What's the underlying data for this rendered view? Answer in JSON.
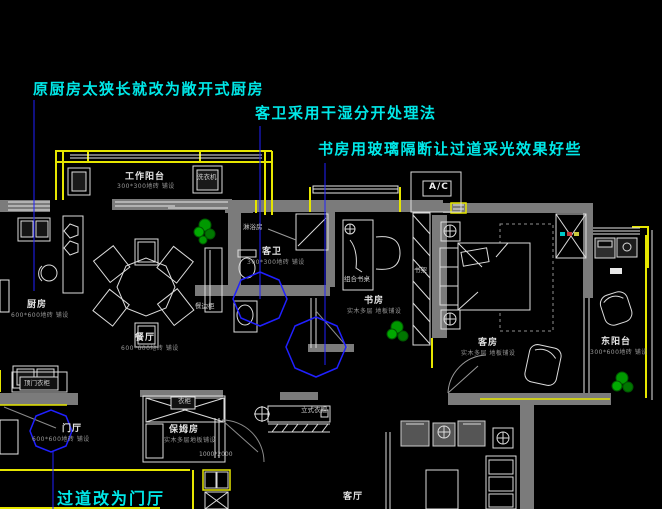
{
  "annotations": [
    {
      "name": "annotation-kitchen",
      "cls": "ann",
      "x": 33,
      "y": 81,
      "text": "原厨房太狭长就改为敞开式厨房"
    },
    {
      "name": "annotation-guest-bath",
      "cls": "ann",
      "x": 255,
      "y": 105,
      "text": "客卫采用干湿分开处理法"
    },
    {
      "name": "annotation-study",
      "cls": "ann",
      "x": 318,
      "y": 141,
      "text": "书房用玻璃隔断让过道采光效果好些"
    },
    {
      "name": "annotation-hallway",
      "cls": "ann ann-big",
      "x": 57,
      "y": 490,
      "text": "过道改为门厅"
    }
  ],
  "labels": [
    {
      "name": "room-label-work-balcony",
      "cls": "room",
      "x": 125,
      "y": 173,
      "text": "工作阳台"
    },
    {
      "name": "tile-note-work-balcony",
      "cls": "note",
      "x": 117,
      "y": 184,
      "text": "300*300地砖 铺设"
    },
    {
      "name": "furniture-label-washing-machine",
      "cls": "tiny",
      "x": 197,
      "y": 174,
      "text": "洗衣机"
    },
    {
      "name": "room-label-kitchen",
      "cls": "room",
      "x": 27,
      "y": 301,
      "text": "厨房"
    },
    {
      "name": "tile-note-kitchen",
      "cls": "note",
      "x": 11,
      "y": 313,
      "text": "600*600地砖 铺设"
    },
    {
      "name": "room-label-dining",
      "cls": "room",
      "x": 135,
      "y": 334,
      "text": "餐厅"
    },
    {
      "name": "tile-note-dining",
      "cls": "note",
      "x": 121,
      "y": 346,
      "text": "600*600地砖 铺设"
    },
    {
      "name": "furniture-label-sideboard",
      "cls": "tiny",
      "x": 195,
      "y": 303,
      "text": "餐边柜"
    },
    {
      "name": "room-label-guest-bath",
      "cls": "room",
      "x": 262,
      "y": 248,
      "text": "客卫"
    },
    {
      "name": "tile-note-guest-bath",
      "cls": "note",
      "x": 247,
      "y": 260,
      "text": "300*300地砖 铺设"
    },
    {
      "name": "furniture-label-shower",
      "cls": "tiny",
      "x": 243,
      "y": 224,
      "text": "淋浴房"
    },
    {
      "name": "room-label-study",
      "cls": "room",
      "x": 364,
      "y": 297,
      "text": "书房"
    },
    {
      "name": "tile-note-study",
      "cls": "note",
      "x": 347,
      "y": 309,
      "text": "实木多层 地板铺设"
    },
    {
      "name": "furniture-label-bookshelf",
      "cls": "tiny",
      "x": 414,
      "y": 267,
      "text": "书架"
    },
    {
      "name": "furniture-label-desk",
      "cls": "tiny",
      "x": 344,
      "y": 276,
      "text": "组合书桌"
    },
    {
      "name": "room-label-guest-room",
      "cls": "room",
      "x": 478,
      "y": 339,
      "text": "客房"
    },
    {
      "name": "tile-note-guest-room",
      "cls": "note",
      "x": 461,
      "y": 351,
      "text": "实木多层 地板铺设"
    },
    {
      "name": "room-label-east-balcony",
      "cls": "room",
      "x": 601,
      "y": 338,
      "text": "东阳台"
    },
    {
      "name": "tile-note-east-balcony",
      "cls": "note",
      "x": 590,
      "y": 350,
      "text": "300*600地砖 铺设"
    },
    {
      "name": "label-ac-unit",
      "cls": "ac",
      "x": 429,
      "y": 183,
      "text": "A/C"
    },
    {
      "name": "room-label-entry-hall",
      "cls": "room",
      "x": 62,
      "y": 425,
      "text": "门厅"
    },
    {
      "name": "tile-note-entry-hall",
      "cls": "note",
      "x": 32,
      "y": 437,
      "text": "600*600地砖 铺设"
    },
    {
      "name": "furniture-label-entry-cabinet",
      "cls": "tiny",
      "x": 24,
      "y": 380,
      "text": "顶门衣柜"
    },
    {
      "name": "room-label-nanny-room",
      "cls": "room",
      "x": 169,
      "y": 426,
      "text": "保姆房"
    },
    {
      "name": "tile-note-nanny-room",
      "cls": "note",
      "x": 164,
      "y": 438,
      "text": "实木多层地板铺设"
    },
    {
      "name": "furniture-label-wardrobe",
      "cls": "tiny",
      "x": 178,
      "y": 398,
      "text": "衣柜"
    },
    {
      "name": "dim-door",
      "cls": "dim",
      "x": 199,
      "y": 452,
      "text": "1000*2000"
    },
    {
      "name": "furniture-label-coat-rack",
      "cls": "tiny",
      "x": 301,
      "y": 407,
      "text": "立式衣帽"
    },
    {
      "name": "room-label-living-room",
      "cls": "room",
      "x": 343,
      "y": 493,
      "text": "客厅"
    }
  ],
  "colors": {
    "background": "#000000",
    "annotation": "#00e8e8",
    "leader": "#2020ff",
    "wall": "#7b7b7b",
    "window": "#ffff00",
    "line": "#e8e8e8",
    "plant": "#009900"
  }
}
